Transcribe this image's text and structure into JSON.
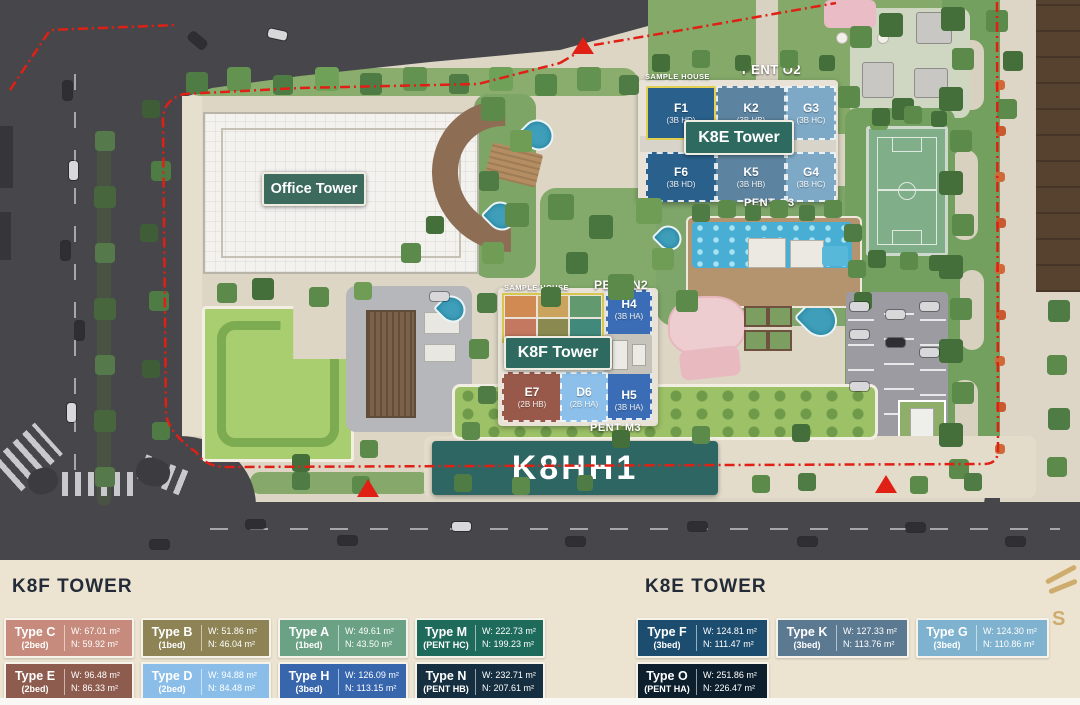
{
  "map": {
    "labels": {
      "office_tower": "Office Tower",
      "k8e_tower": "K8E Tower",
      "k8f_tower": "K8F Tower",
      "k8hh1": "K8HH1",
      "sample_house_k8e": "SAMPLE HOUSE",
      "sample_house_k8f": "SAMPLE HOUSE",
      "pent_o2": "PENT O2",
      "pent_o3": "PENT O3",
      "pent_n2": "PENT N2",
      "pent_m3": "PENT M3"
    },
    "k8e_units": [
      {
        "code": "F1",
        "type": "(3B HD)"
      },
      {
        "code": "K2",
        "type": "(3B HB)"
      },
      {
        "code": "G3",
        "type": "(3B HC)"
      },
      {
        "code": "F6",
        "type": "(3B HD)"
      },
      {
        "code": "K5",
        "type": "(3B HB)"
      },
      {
        "code": "G4",
        "type": "(3B HC)"
      }
    ],
    "k8f_units": {
      "h4": {
        "code": "H4",
        "type": "(3B HA)"
      },
      "h5": {
        "code": "H5",
        "type": "(3B HA)"
      },
      "e7": {
        "code": "E7",
        "type": "(2B HB)"
      },
      "d6": {
        "code": "D6",
        "type": "(2B HA)"
      }
    },
    "boundary_color": "#e02015"
  },
  "legend": {
    "k8f": {
      "title": "K8F TOWER",
      "items": [
        {
          "name": "Type C",
          "bed": "(2bed)",
          "w": "W: 67.01 m²",
          "n": "N: 59.92 m²",
          "color": "#c68b7c"
        },
        {
          "name": "Type B",
          "bed": "(1bed)",
          "w": "W: 51.86 m²",
          "n": "N: 46.04 m²",
          "color": "#8d8355"
        },
        {
          "name": "Type A",
          "bed": "(1bed)",
          "w": "W: 49.61 m²",
          "n": "N: 43.50 m²",
          "color": "#6ba184"
        },
        {
          "name": "Type M",
          "bed": "(PENT HC)",
          "w": "W: 222.73 m²",
          "n": "N: 199.23 m²",
          "color": "#1e6b5b"
        },
        {
          "name": "Type E",
          "bed": "(2bed)",
          "w": "W: 96.48 m²",
          "n": "N: 86.33 m²",
          "color": "#8d5c4e"
        },
        {
          "name": "Type D",
          "bed": "(2bed)",
          "w": "W: 94.88 m²",
          "n": "N: 84.48 m²",
          "color": "#8abde8"
        },
        {
          "name": "Type H",
          "bed": "(3bed)",
          "w": "W: 126.09 m²",
          "n": "N: 113.15 m²",
          "color": "#3766ad"
        },
        {
          "name": "Type N",
          "bed": "(PENT HB)",
          "w": "W: 232.71 m²",
          "n": "N: 207.61 m²",
          "color": "#152f40"
        }
      ]
    },
    "k8e": {
      "title": "K8E TOWER",
      "items": [
        {
          "name": "Type F",
          "bed": "(3bed)",
          "w": "W: 124.81 m²",
          "n": "N: 111.47 m²",
          "color": "#1c4c6e"
        },
        {
          "name": "Type K",
          "bed": "(3bed)",
          "w": "W: 127.33 m²",
          "n": "N: 113.76 m²",
          "color": "#5b7991"
        },
        {
          "name": "Type G",
          "bed": "(3bed)",
          "w": "W: 124.30 m²",
          "n": "N: 110.86 m²",
          "color": "#7fb2cf"
        },
        {
          "name": "Type O",
          "bed": "(PENT HA)",
          "w": "W: 251.86 m²",
          "n": "N: 226.47 m²",
          "color": "#0d1f2c"
        }
      ]
    },
    "watermark": "S"
  }
}
